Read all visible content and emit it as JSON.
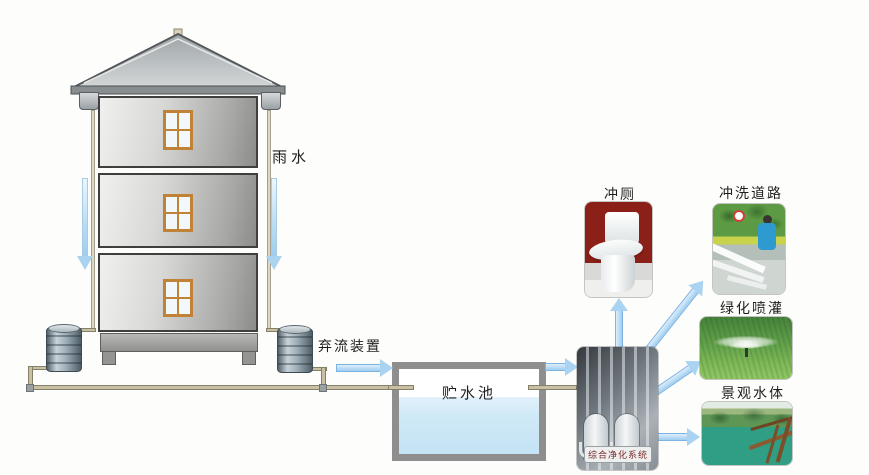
{
  "diagram": {
    "type": "flow-diagram",
    "labels": {
      "rainwater": "雨水",
      "first_flush_device": "弃流装置",
      "storage_pool": "贮水池",
      "purification_system": "综合净化系统",
      "toilet_flushing": "冲厕",
      "road_washing": "冲洗道路",
      "greening_irrigation": "绿化喷灌",
      "landscape_water": "景观水体"
    },
    "flows": [
      {
        "from": "雨水",
        "to": "弃流装置"
      },
      {
        "from": "弃流装置",
        "to": "贮水池"
      },
      {
        "from": "贮水池",
        "to": "综合净化系统"
      },
      {
        "from": "综合净化系统",
        "to": "冲厕"
      },
      {
        "from": "综合净化系统",
        "to": "冲洗道路"
      },
      {
        "from": "综合净化系统",
        "to": "绿化喷灌"
      },
      {
        "from": "综合净化系统",
        "to": "景观水体"
      }
    ],
    "images": [
      {
        "name": "house-cross-section"
      },
      {
        "name": "first-flush-barrel",
        "count": 2
      },
      {
        "name": "purification-system-photo"
      },
      {
        "name": "toilet-photo"
      },
      {
        "name": "road-washing-photo"
      },
      {
        "name": "sprinkler-irrigation-photo"
      },
      {
        "name": "landscape-pond-photo"
      }
    ],
    "colors": {
      "arrow_fill": "#a9d3f0",
      "arrow_border": "#7db4e2",
      "pipe": "#c9c0a4",
      "pool_wall": "#8e8e8e",
      "pool_water": "#cfe9f7",
      "window_frame": "#c08236",
      "toilet_bg_red": "#8b2018",
      "grass_green": "#63a24b",
      "pond_teal": "#2f9e84",
      "label_text": "#1f1f1f",
      "purify_label_text": "#7b2b2b"
    }
  }
}
